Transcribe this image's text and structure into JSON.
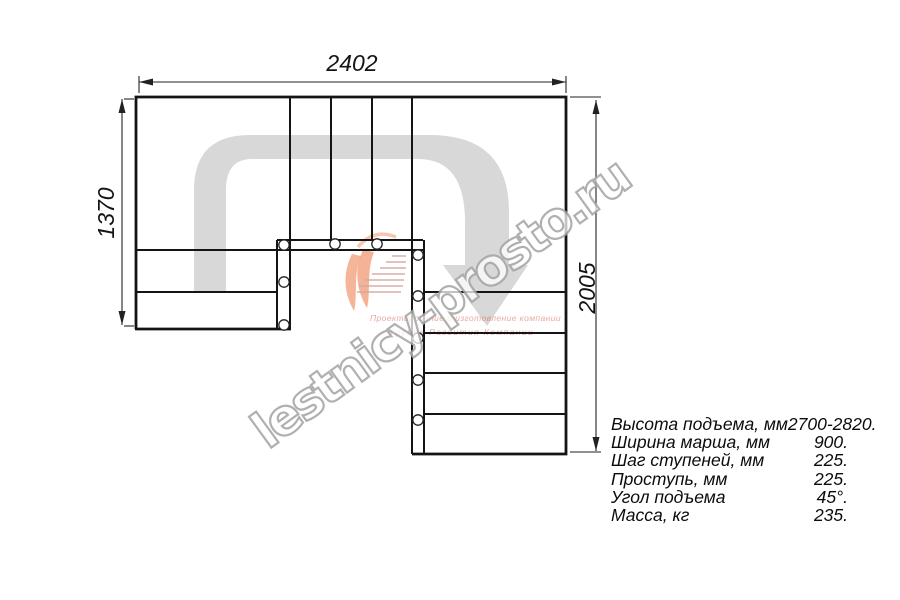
{
  "drawing": {
    "type": "stair-plan-top-view",
    "dimensions": {
      "top": "2402",
      "left": "1370",
      "right": "2005"
    }
  },
  "specs": {
    "rows": [
      {
        "label": "Высота подъема, мм",
        "value": "2700-2820."
      },
      {
        "label": "Ширина марша, мм",
        "value": "900."
      },
      {
        "label": "Шаг ступеней, мм",
        "value": "225."
      },
      {
        "label": "Проступь, мм",
        "value": "225."
      },
      {
        "label": "Угол подъема",
        "value": "45°."
      },
      {
        "label": "Масса, кг",
        "value": "235."
      }
    ]
  },
  "watermark": {
    "site": "lestnicy-prosto.ru",
    "slogan1": "Проектирование и изготовление компании",
    "slogan2": "Группа Развития Компании"
  },
  "colors": {
    "line": "#141414",
    "walk_band": "#d8d8d8",
    "watermark_gray": "#a6a6a6",
    "logo_orange": "#ef7f4e",
    "logo_red": "#cc4433"
  }
}
